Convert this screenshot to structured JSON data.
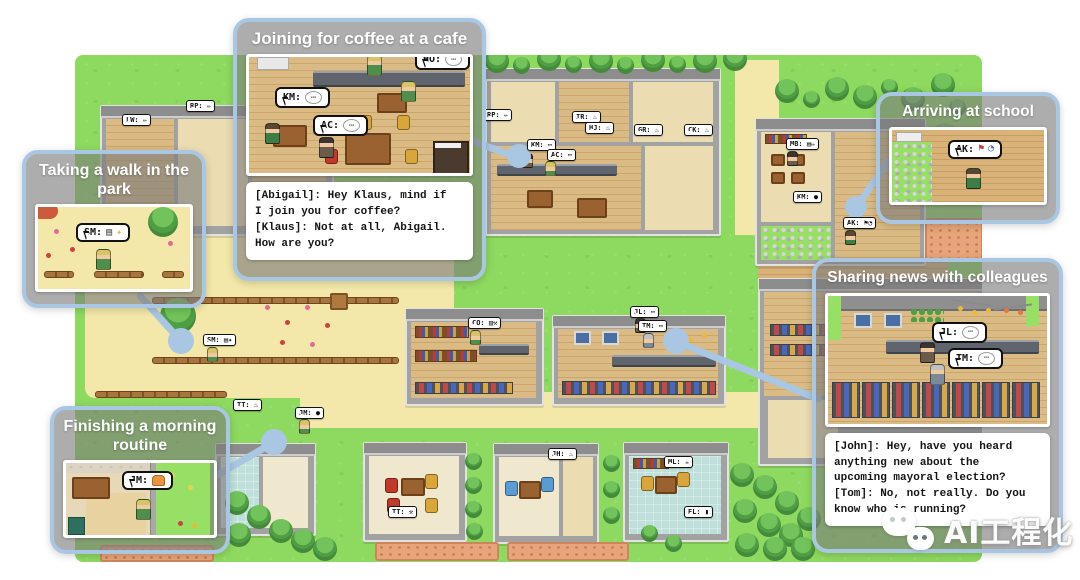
{
  "panels": {
    "walk": {
      "title": "Taking a walk in the park",
      "agent_bubble": "SM:"
    },
    "coffee": {
      "title": "Joining for coffee at a cafe",
      "bubble_km": "KM:",
      "bubble_ac": "AC:",
      "bubble_ho": "HO:",
      "dialogue": "[Abigail]: Hey Klaus, mind if\nI join you for coffee?\n[Klaus]: Not at all, Abigail.\nHow are you?"
    },
    "school": {
      "title": "Arriving at school",
      "agent_bubble": "AK:"
    },
    "routine": {
      "title": "Finishing a morning routine",
      "agent_bubble": "JM:"
    },
    "sharing": {
      "title": "Sharing news with colleagues",
      "bubble_jl": "JL:",
      "bubble_tm": "TM:",
      "dialogue": "[John]: Hey, have you heard\nanything new about the\nupcoming mayoral election?\n[Tom]: No, not really. Do you\nknow who is running?"
    }
  },
  "icons": {
    "chat": "⋯",
    "book": "▤",
    "sparkle": "✦",
    "flag": "⚑",
    "clock": "◔"
  },
  "map_bubbles": [
    {
      "text": "LW: ✏"
    },
    {
      "text": "RP: ✏"
    },
    {
      "text": "RP: ✏"
    },
    {
      "text": "IR: ♨"
    },
    {
      "text": "HJ: ♨"
    },
    {
      "text": "KM: ⋯"
    },
    {
      "text": "AC: ⋯"
    },
    {
      "text": "GR: ♨"
    },
    {
      "text": "CK: ♨"
    },
    {
      "text": "MB: ▤✏"
    },
    {
      "text": "KM: ●"
    },
    {
      "text": "AK: ⚑◔"
    },
    {
      "text": "SM: ▤✦"
    },
    {
      "text": "CO: ▥⚒"
    },
    {
      "text": "JL: ⋯"
    },
    {
      "text": "TM: ⋯"
    },
    {
      "text": "TT: ♨"
    },
    {
      "text": "JM: ●"
    },
    {
      "text": "TT: ⚒"
    },
    {
      "text": "JH: ♨"
    },
    {
      "text": "ML: ☕"
    },
    {
      "text": "EL: ▮"
    }
  ],
  "watermark": {
    "text": "AI工程化"
  },
  "colors": {
    "panel_border": "#a9c6e3",
    "connector": "#a9c6e3",
    "grass": "#8ed95f",
    "path": "#f3e8a9"
  }
}
